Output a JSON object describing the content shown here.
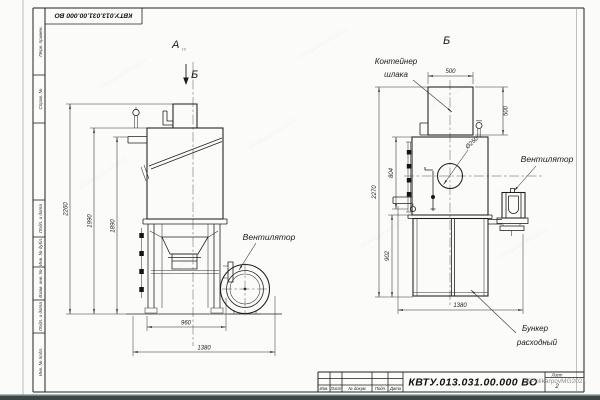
{
  "doc": {
    "number": "КВТУ.013.031.00.000  ВО",
    "number_stamp": "КВТУ.013.031.00.000  ВО"
  },
  "frame": {
    "side_labels": [
      "Перв. примен.",
      "Справ. №",
      "Подп. и дата",
      "Инв. № дубл.",
      "Взам. инв. №",
      "Подп. и дата",
      "Инв. № подл."
    ]
  },
  "title_block": {
    "row_labels": [
      "Изм.",
      "Лист",
      "№ докум.",
      "Подп.",
      "Дата"
    ],
    "sheet_label": "Лист",
    "sheet_number": "2"
  },
  "views": {
    "a_label": "А",
    "a_sub": "10",
    "a_section_arrow": "Б",
    "b_label": "Б"
  },
  "callouts": {
    "fan_left": "Вентилятор",
    "fan_right": "Вентилятор",
    "slag_container": [
      "Контейнер",
      "шлака"
    ],
    "hopper": [
      "Бункер",
      "расходный"
    ],
    "hole_diameter": "Ø250"
  },
  "dimensions": {
    "view_a": {
      "total_height": "2260",
      "body_top_height": "1990",
      "pipe_height": "1890",
      "frame_width": "960",
      "total_width": "1380"
    },
    "view_b": {
      "container_width": "500",
      "container_height": "500",
      "total_height": "2270",
      "body_height": "804",
      "hopper_height": "902",
      "total_width": "1380"
    }
  },
  "watermark": "©PolikarpovMG2021"
}
